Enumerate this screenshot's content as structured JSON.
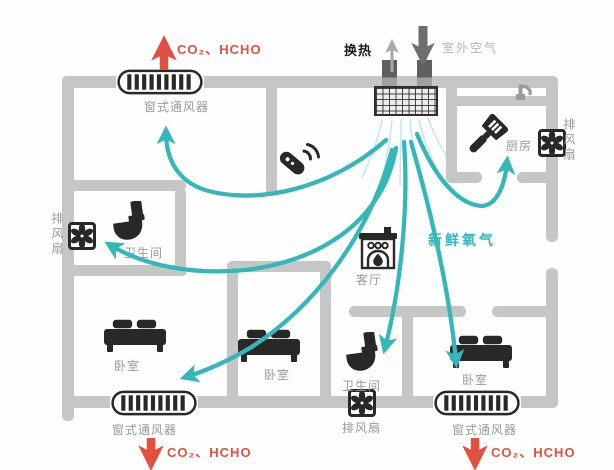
{
  "colors": {
    "fresh_air": "#35b7b7",
    "exhaust": "#e2503f",
    "wall": "#c6c6c6",
    "icon": "#282828",
    "label": "#9a9a9a",
    "muted": "#b5b5b5",
    "outdoor_arrow": "#6e6e6e"
  },
  "unit": {
    "heat_exchange": "换热",
    "outdoor_air": "室外空气"
  },
  "flows": {
    "fresh_oxygen": "新鲜氧气",
    "exhaust_gases": "CO₂、HCHO"
  },
  "rooms": {
    "bathroom": "卫生间",
    "bedroom": "卧室",
    "living_room": "客厅",
    "kitchen": "厨房"
  },
  "devices": {
    "window_ventilator": "窗式通风器",
    "exhaust_fan": "排风扇"
  }
}
